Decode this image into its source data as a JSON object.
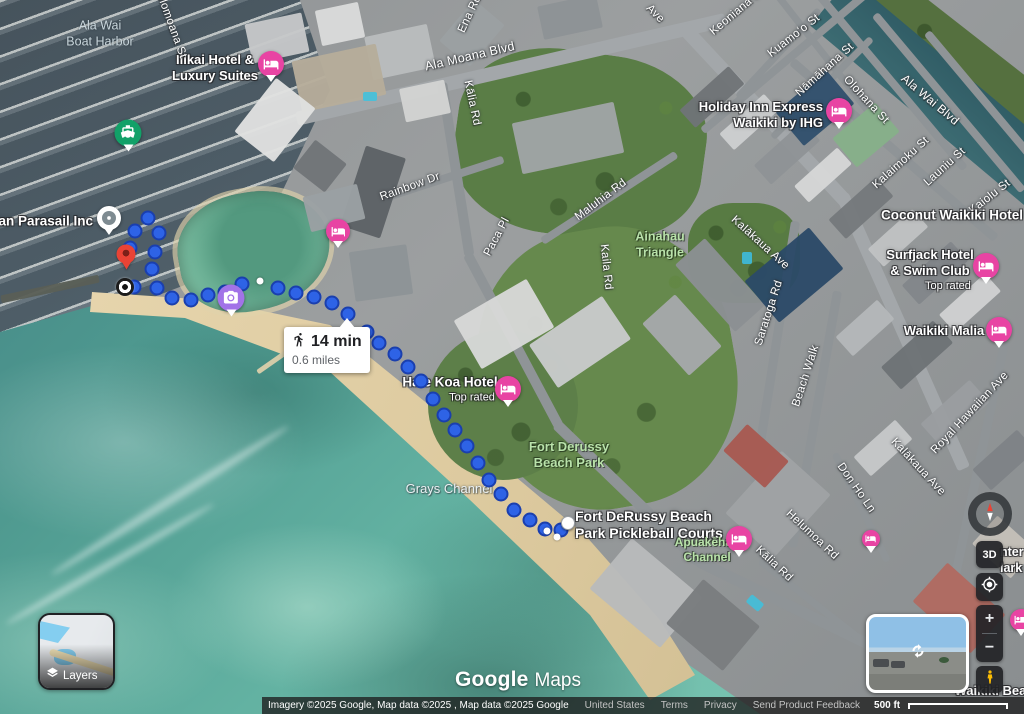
{
  "watermark": {
    "brand": "Google",
    "product": "Maps"
  },
  "route": {
    "mode": "walking",
    "tooltip": {
      "duration": "14 min",
      "distance": "0.6 miles"
    },
    "dots": [
      [
        148,
        218
      ],
      [
        135,
        231
      ],
      [
        159,
        233
      ],
      [
        130,
        248
      ],
      [
        155,
        252
      ],
      [
        152,
        269
      ],
      [
        134,
        287
      ],
      [
        157,
        288
      ],
      [
        172,
        298
      ],
      [
        191,
        300
      ],
      [
        208,
        295
      ],
      [
        225,
        292
      ],
      [
        242,
        284
      ],
      [
        278,
        288
      ],
      [
        296,
        293
      ],
      [
        314,
        297
      ],
      [
        332,
        303
      ],
      [
        348,
        314
      ],
      [
        367,
        332
      ],
      [
        379,
        343
      ],
      [
        395,
        354
      ],
      [
        408,
        367
      ],
      [
        421,
        381
      ],
      [
        433,
        399
      ],
      [
        444,
        415
      ],
      [
        455,
        430
      ],
      [
        467,
        446
      ],
      [
        478,
        463
      ],
      [
        489,
        480
      ],
      [
        501,
        494
      ],
      [
        514,
        510
      ],
      [
        530,
        520
      ],
      [
        545,
        529
      ],
      [
        561,
        530
      ]
    ],
    "small_dots": [
      [
        260,
        281
      ],
      [
        547,
        531
      ],
      [
        557,
        537
      ]
    ]
  },
  "labels": {
    "boat_harbor_1": "Ala Wai",
    "boat_harbor_2": "Boat Harbor",
    "ilikai_1": "Ilikai Hotel &",
    "ilikai_2": "Luxury Suites",
    "parasail": "Hawaiian Parasail Inc",
    "holomoana_st": "Holomoana St",
    "ena_rd": "Ena Rd",
    "ala_moana_blvd": "Ala Moana Blvd",
    "kalia_rd_top": "Kālia Rd",
    "rainbow_dr": "Rainbow Dr",
    "paca_pl": "Paca Pl",
    "maluhia_rd": "Maluhia Rd",
    "kaila_rd": "Kaila Rd",
    "ainahau_1": "Ainahau",
    "ainahau_2": "Triangle",
    "keoniana_st": "Keoniana St",
    "kuamoo_st": "Kuamoʻo St",
    "namahana_st": "Nāmāhana St",
    "holiday_inn_1": "Holiday Inn Express",
    "holiday_inn_2": "Waikiki by IHG",
    "olohana_st": "Olohana St",
    "ala_wai_blvd": "Ala Wai Blvd",
    "kalaimoku_st": "Kalaimoku St",
    "launiu_st": "Launiu St",
    "kaiolu_st": "Kaiolu St",
    "ave_fragment": "Ave",
    "coconut_waikiki": "Coconut Waikiki Hotel",
    "surfjack_1": "Surfjack Hotel",
    "surfjack_2": "& Swim Club",
    "surfjack_sub": "Top rated",
    "waikiki_malia": "Waikiki Malia",
    "kalakaua_ave_upper": "Kalākaua Ave",
    "kalakaua_ave_lower": "Kalākaua Ave",
    "saratoga_rd": "Saratoga Rd",
    "beach_walk": "Beach Walk",
    "royal_hawaiian_ave": "Royal Hawaiian Ave",
    "hale_koa": "Hale Koa Hotel",
    "hale_koa_sub": "Top rated",
    "fort_derussy_1": "Fort Derussy",
    "fort_derussy_2": "Beach Park",
    "grays_channel": "Grays Channel",
    "pickleball_1": "Fort DeRussy Beach",
    "pickleball_2": "Park Pickleball Courts",
    "apuakehau_1": "Apuakēhau",
    "apuakehau_2": "Channel",
    "don_ho_ln": "Don Ho Ln",
    "helumoa_rd": "Helumoa Rd",
    "kalia_rd_bottom": "Kālia Rd",
    "waikiki_beach": "Waikiki Beach",
    "clipped_right_1": "nter",
    "clipped_right_2": "lark"
  },
  "pins": [
    {
      "name": "ilikai-hotel",
      "x": 271,
      "y": 64,
      "size": 26,
      "color": "#e844a3",
      "icon": "bed"
    },
    {
      "name": "lagoon-hotel",
      "x": 338,
      "y": 231,
      "size": 24,
      "color": "#e844a3",
      "icon": "bed"
    },
    {
      "name": "holiday-inn",
      "x": 839,
      "y": 111,
      "size": 26,
      "color": "#e844a3",
      "icon": "bed"
    },
    {
      "name": "surfjack-hotel",
      "x": 986,
      "y": 266,
      "size": 26,
      "color": "#e844a3",
      "icon": "bed"
    },
    {
      "name": "waikiki-malia",
      "x": 999,
      "y": 330,
      "size": 26,
      "color": "#e844a3",
      "icon": "bed"
    },
    {
      "name": "hale-koa-hotel",
      "x": 508,
      "y": 389,
      "size": 26,
      "color": "#e844a3",
      "icon": "bed"
    },
    {
      "name": "apuakehau-hotel",
      "x": 739,
      "y": 539,
      "size": 26,
      "color": "#e844a3",
      "icon": "bed"
    },
    {
      "name": "small-hotel",
      "x": 871,
      "y": 539,
      "size": 18,
      "color": "#e844a3",
      "icon": "bed"
    },
    {
      "name": "edge-hotel",
      "x": 1021,
      "y": 620,
      "size": 22,
      "color": "#e844a3",
      "icon": "bed"
    },
    {
      "name": "boat-tours",
      "x": 128,
      "y": 133,
      "size": 27,
      "color": "#12a168",
      "icon": "boat"
    },
    {
      "name": "photo-spot",
      "x": 231,
      "y": 298,
      "size": 27,
      "color": "#a273e8",
      "icon": "camera"
    },
    {
      "name": "hawaiian-parasail",
      "x": 109,
      "y": 218,
      "size": 24,
      "color": "#ffffff",
      "icon": "dot"
    }
  ],
  "controls": {
    "layers": "Layers",
    "three_d": "3D",
    "zoom_in": "+",
    "zoom_out": "−"
  },
  "attribution": {
    "imagery": "Imagery ©2025 Google, Map data ©2025 , Map data ©2025 Google",
    "links": [
      "United States",
      "Terms",
      "Privacy",
      "Send Product Feedback"
    ],
    "scale": "500 ft"
  }
}
